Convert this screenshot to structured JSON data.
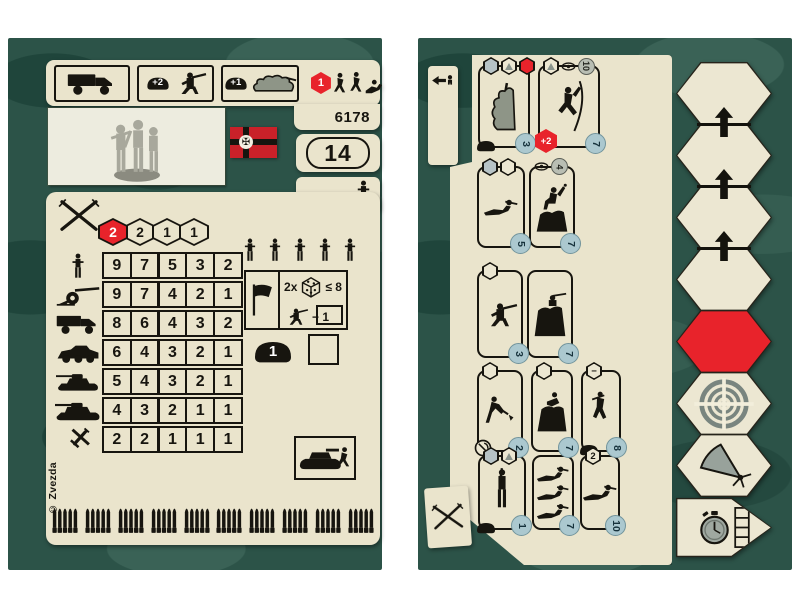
{
  "page": {
    "background_color": "#ffffff",
    "camouflage": {
      "base": "#2c5348",
      "dark": "#1f453b",
      "light": "#3a6256"
    }
  },
  "left_card": {
    "catalog_number": "6178",
    "point_value": "14",
    "copyright": "© Zvezda",
    "flag": {
      "name": "german-war-ensign",
      "cross_glyph": "✠",
      "field_color": "#c92129"
    },
    "header": {
      "slots": [
        {
          "icon": "truck"
        },
        {
          "icon": "soldier-firing",
          "helmet_badge": "+2"
        },
        {
          "icon": "camouflage-emplacement",
          "helmet_badge": "+1"
        },
        {
          "icon": "advancing-squad",
          "hex_badge": "1",
          "frameless": true
        }
      ]
    },
    "attack_dice_hexes": {
      "values": [
        "2",
        "2",
        "1",
        "1"
      ],
      "active_index": 0
    },
    "combat_table": {
      "rows": [
        {
          "target": "infantry",
          "color": "black",
          "values": [
            "9",
            "7",
            "5",
            "3",
            "2"
          ]
        },
        {
          "target": "artillery",
          "color": "black",
          "values": [
            "9",
            "7",
            "4",
            "2",
            "1"
          ]
        },
        {
          "target": "truck",
          "color": "black",
          "values": [
            "8",
            "6",
            "4",
            "3",
            "2"
          ]
        },
        {
          "target": "armored-car",
          "color": "red",
          "values": [
            "6",
            "4",
            "3",
            "2",
            "1"
          ]
        },
        {
          "target": "light-tank",
          "color": "red",
          "values": [
            "5",
            "4",
            "3",
            "2",
            "1"
          ]
        },
        {
          "target": "heavy-tank",
          "color": "red",
          "values": [
            "4",
            "3",
            "2",
            "1",
            "1"
          ]
        },
        {
          "target": "aircraft",
          "color": "red",
          "values": [
            "2",
            "2",
            "1",
            "1",
            "1"
          ]
        }
      ]
    },
    "squad": {
      "soldier_count": 5
    },
    "morale_check": {
      "multiplier": "2x",
      "threshold": "≤ 8",
      "penalty": "− 1"
    },
    "armor": {
      "helmet_value": "1"
    }
  },
  "right_card": {
    "order_rows": [
      {
        "panels": [
          {
            "badges": [
              "hex-gray",
              "hex-triangle",
              "hex-red"
            ],
            "figure": "camouflage-emplacement-tall",
            "footer_icons": [
              "helmet"
            ],
            "cost": "3"
          },
          {
            "badges": [
              "hex-triangle",
              "eye",
              "circle-gray:10"
            ],
            "figure": "climbing-soldier",
            "footer_icons": [
              "red-hex:+2"
            ],
            "cost": "7"
          }
        ]
      },
      {
        "panels": [
          {
            "badges": [
              "hex-gray",
              "hex-outline"
            ],
            "figure": "crawling-soldier",
            "cost": "5"
          },
          {
            "badges": [
              "eye",
              "circle-gray:4"
            ],
            "figure": "grenade-thrower",
            "cost": "7"
          }
        ]
      },
      {
        "panels": [
          {
            "badges": [
              "hex-outline"
            ],
            "figure": "kneeling-shooter",
            "cost": "3"
          },
          {
            "badges": [],
            "figure": "soldier-in-foxhole",
            "cost": "7"
          }
        ]
      },
      {
        "panels": [
          {
            "badges": [
              "hex-outline"
            ],
            "figure": "digging-soldier",
            "footer_icons": [
              "entrench-tool"
            ],
            "cost": "2"
          },
          {
            "badges": [
              "hex-outline"
            ],
            "figure": "climbing-out-soldier",
            "cost": "7"
          },
          {
            "badges": [
              "hex-minus"
            ],
            "figure": "descending-soldier",
            "footer_icons": [
              "helmet"
            ],
            "cost": "8"
          }
        ]
      },
      {
        "panels": [
          {
            "badges": [
              "hex-gray",
              "hex-triangle"
            ],
            "figure": "standing-shooter",
            "footer_icons": [
              "helmet"
            ],
            "cost": "1"
          },
          {
            "badges": [],
            "figure": "three-crawlers",
            "cost": "7"
          },
          {
            "badges": [
              "hex:2"
            ],
            "figure": "crawling-soldier",
            "cost": "10"
          }
        ]
      }
    ]
  },
  "hex_track": {
    "cells": [
      {
        "style": "plain"
      },
      {
        "style": "plain",
        "arrow_above": true
      },
      {
        "style": "plain",
        "arrow_above": true
      },
      {
        "style": "plain",
        "arrow_above": true
      },
      {
        "style": "red"
      },
      {
        "style": "plain",
        "icon": "target"
      },
      {
        "style": "plain",
        "icon": "mg-arc"
      },
      {
        "style": "pentagon",
        "icon": "stopwatch",
        "icon2": "grid4"
      }
    ]
  }
}
